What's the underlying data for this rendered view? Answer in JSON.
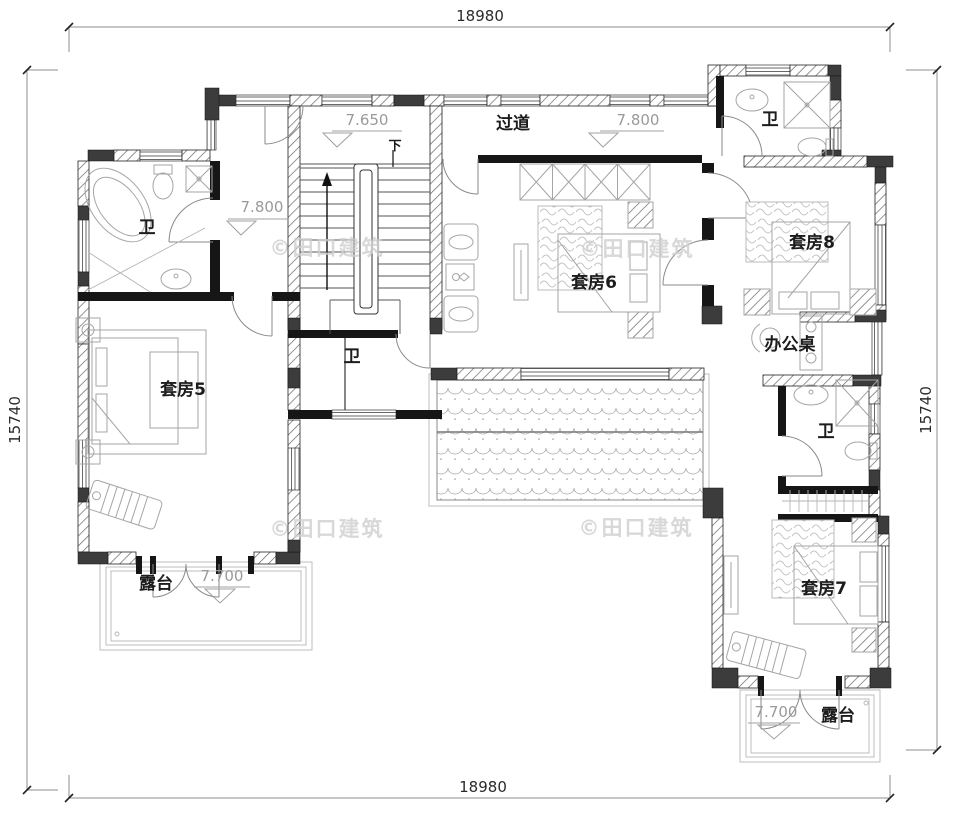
{
  "plan": {
    "dimensions": {
      "top": "18980",
      "bottom": "18980",
      "left": "15740",
      "right": "15740"
    },
    "levels": {
      "stairwell": "7.650",
      "corridor": "7.800",
      "hall": "7.800",
      "terrace_left": "7.700",
      "terrace_right": "7.700"
    },
    "rooms": {
      "corridor": "过道",
      "stairs_down": "下",
      "bath_upper_left": "卫",
      "bath_middle": "卫",
      "bath_upper_right": "卫",
      "bath_right": "卫",
      "suite5": "套房5",
      "suite6": "套房6",
      "suite7": "套房7",
      "suite8": "套房8",
      "desk": "办公桌",
      "terrace_left": "露台",
      "terrace_right": "露台"
    },
    "watermark": "©田口建筑",
    "colors": {
      "wall": "#1a1a1a",
      "wall_fill_dark": "#3c3c3c",
      "hatch_line": "#666666",
      "window_line": "#444444",
      "furniture_line": "#a5a5a5",
      "level_text": "#9a9a9a",
      "label_text": "#1c1c1c",
      "dim_text": "#2b2b2b",
      "watermark": "#cfcfcf"
    }
  }
}
